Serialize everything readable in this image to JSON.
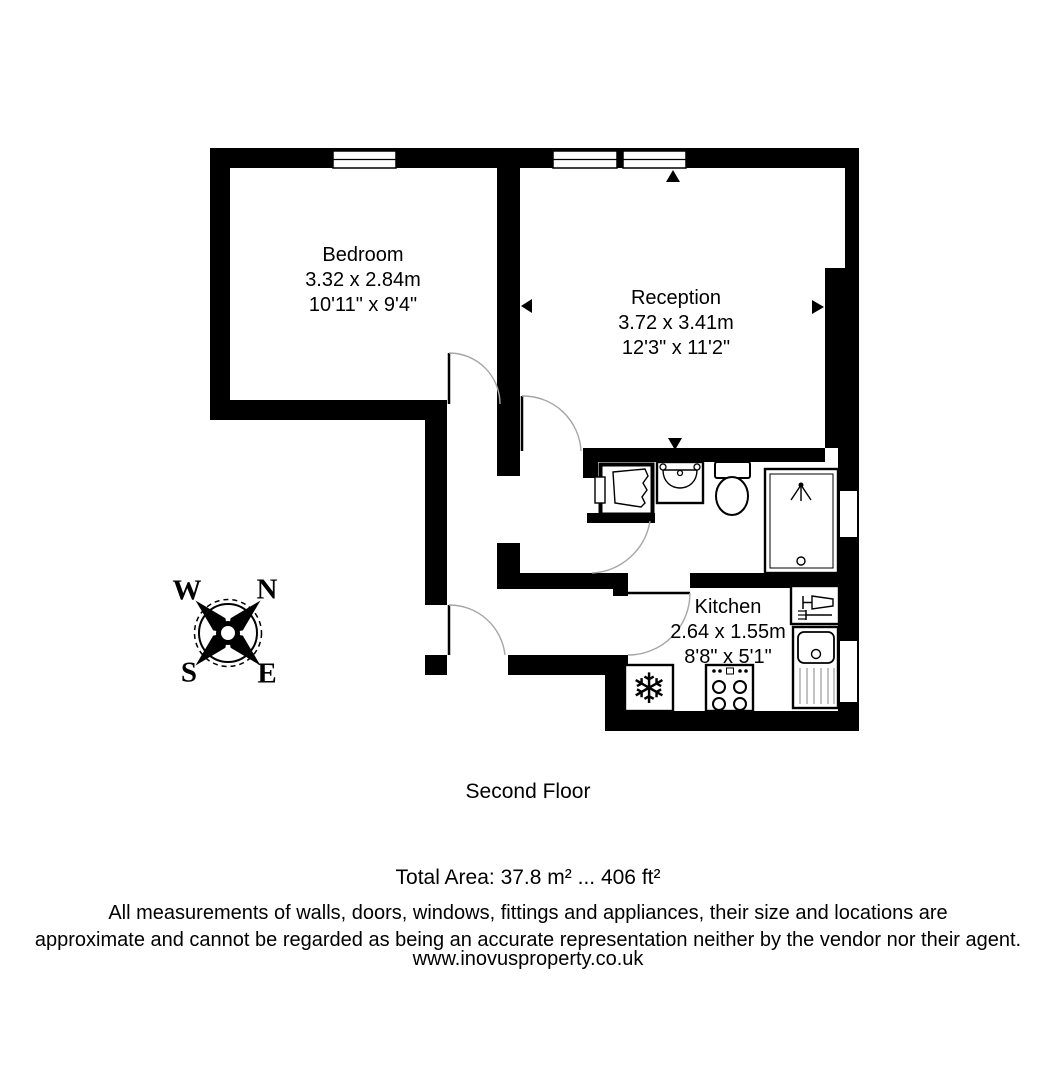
{
  "floor": {
    "label": "Second Floor"
  },
  "rooms": {
    "bedroom": {
      "name": "Bedroom",
      "metric": "3.32 x 2.84m",
      "imperial": "10'11\" x 9'4\""
    },
    "reception": {
      "name": "Reception",
      "metric": "3.72 x 3.41m",
      "imperial": "12'3\" x 11'2\""
    },
    "kitchen": {
      "name": "Kitchen",
      "metric": "2.64 x 1.55m",
      "imperial": "8'8\" x 5'1\""
    }
  },
  "compass": {
    "north": "N",
    "south": "S",
    "east": "E",
    "west": "W"
  },
  "icons": {
    "snowflake": "❄"
  },
  "footer": {
    "total_area": "Total Area: 37.8 m² ... 406 ft²",
    "disclaimer_line1": "All measurements of walls, doors, windows, fittings and appliances, their size and locations are",
    "disclaimer_line2": "approximate and cannot be regarded as being an accurate representation neither by the vendor nor their agent.",
    "website": "www.inovusproperty.co.uk"
  },
  "colors": {
    "wall": "#000000",
    "background": "#ffffff",
    "door_arc": "#a6a6a6"
  }
}
